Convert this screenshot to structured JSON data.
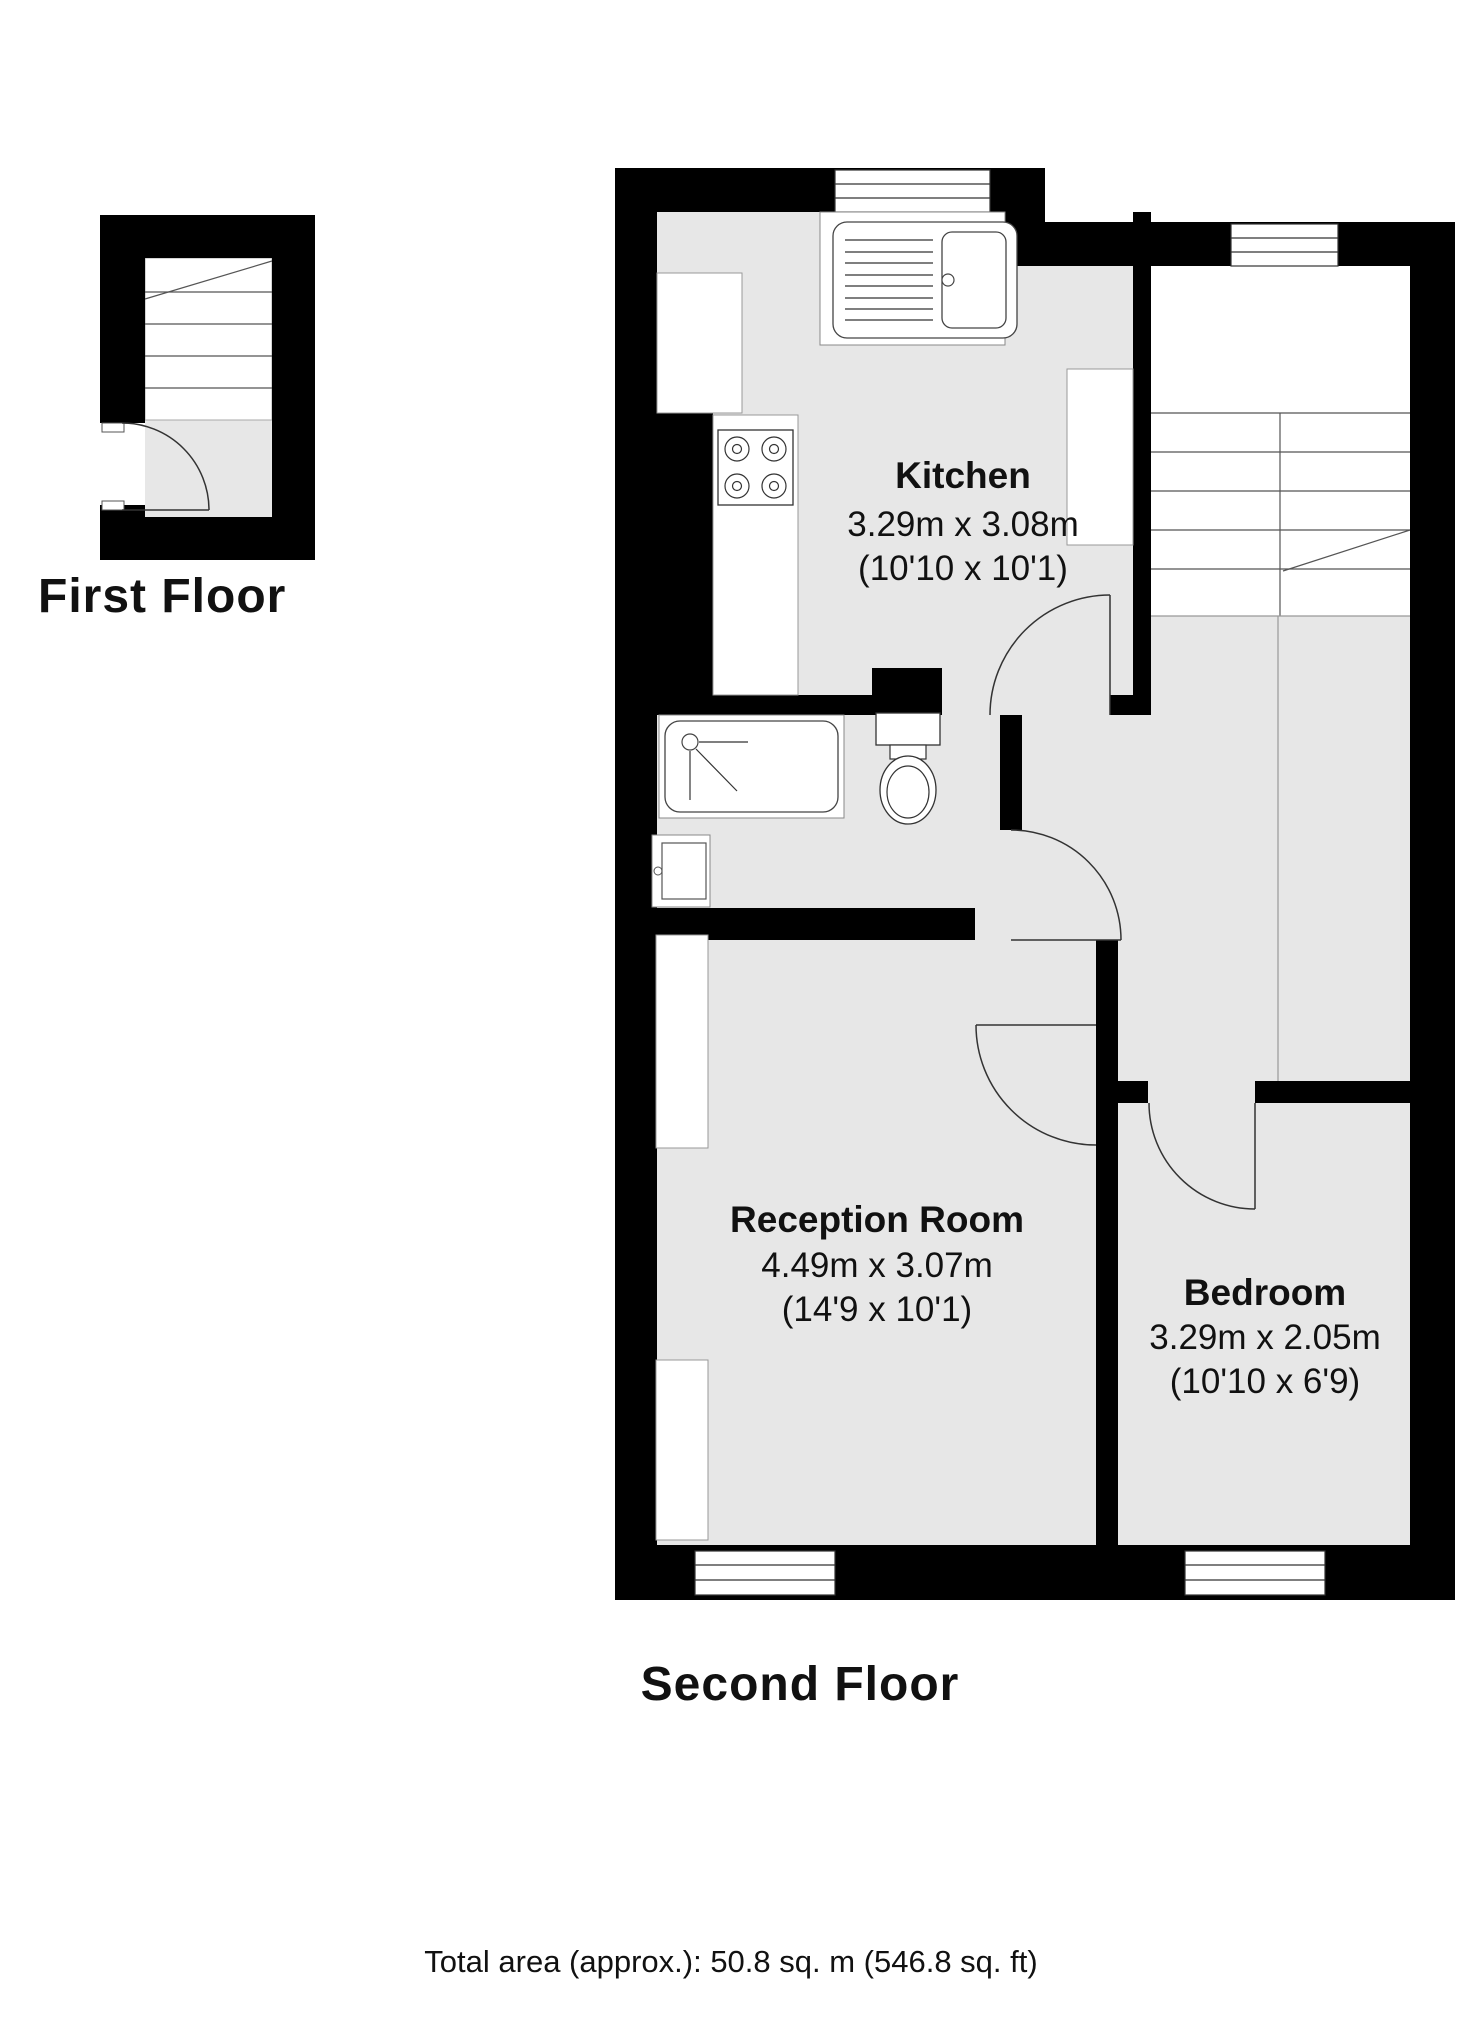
{
  "colors": {
    "wall": "#000000",
    "floor": "#e7e7e7",
    "background": "#ffffff",
    "line": "#333333"
  },
  "first_floor": {
    "label": "First Floor",
    "features": [
      "staircase",
      "landing",
      "entry-door"
    ]
  },
  "second_floor": {
    "label": "Second Floor",
    "rooms": {
      "kitchen": {
        "name": "Kitchen",
        "dim_metric": "3.29m x 3.08m",
        "dim_imperial": "(10'10 x 10'1)"
      },
      "reception": {
        "name": "Reception Room",
        "dim_metric": "4.49m x 3.07m",
        "dim_imperial": "(14'9 x 10'1)"
      },
      "bedroom": {
        "name": "Bedroom",
        "dim_metric": "3.29m x 2.05m",
        "dim_imperial": "(10'10 x 6'9)"
      }
    },
    "fixtures": [
      "sink",
      "stove",
      "bathtub",
      "wash-basin",
      "toilet",
      "staircase"
    ]
  },
  "footer": {
    "total_area": "Total area (approx.): 50.8 sq. m (546.8 sq. ft)"
  }
}
